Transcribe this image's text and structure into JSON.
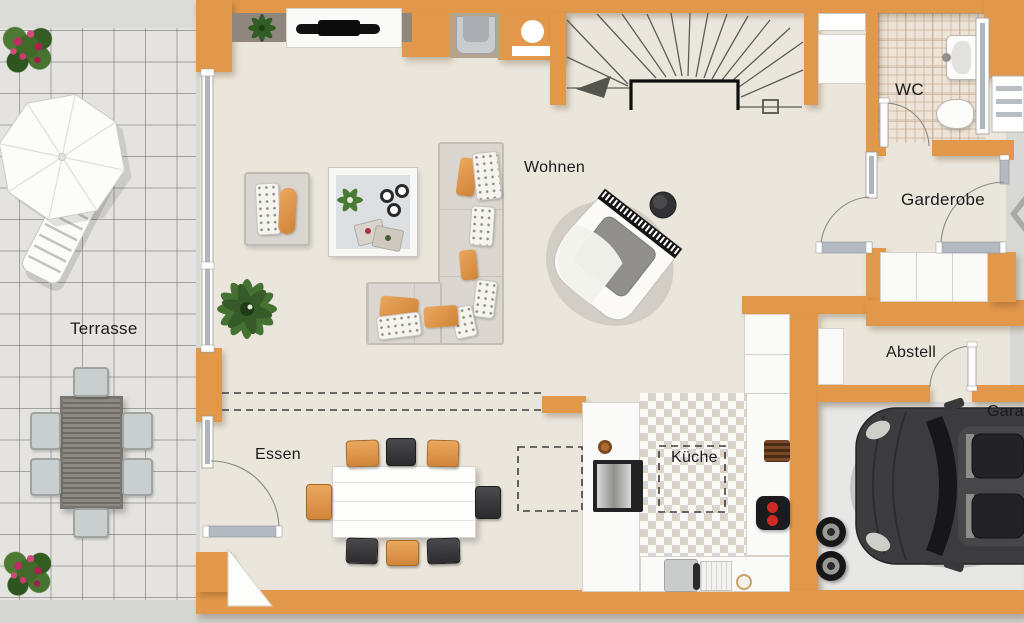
{
  "meta": {
    "title": "Grundriss Erdgeschoss"
  },
  "rooms": {
    "terrasse": {
      "label": "Terrasse"
    },
    "wohnen": {
      "label": "Wohnen"
    },
    "essen": {
      "label": "Essen"
    },
    "kueche": {
      "label": "Küche"
    },
    "wc": {
      "label": "WC"
    },
    "garderobe": {
      "label": "Garderobe"
    },
    "abstell": {
      "label": "Abstell"
    },
    "garage": {
      "label": "Garage"
    }
  },
  "colors": {
    "wall_orange": "#E2984B",
    "interior_floor": "#EBE6DC",
    "terrace_tile": "#E4E3DF",
    "garage_floor": "#E7E7E6",
    "outside_gray": "#D9D9D7",
    "accent_chair_orange": "#E0913F",
    "accent_chair_black": "#3A3A3C",
    "car_body": "#3C3C3F"
  },
  "icons": [
    "sun-umbrella-icon",
    "lounger-icon",
    "outdoor-dining-set-icon",
    "flower-bush-icon",
    "corner-sofa-icon",
    "coffee-table-icon",
    "armchair-icon",
    "plant-icon",
    "tv-sideboard-icon",
    "grand-piano-icon",
    "piano-stool-icon",
    "stair-icon",
    "stair-direction-arrow-icon",
    "dining-table-icon",
    "cooktop-icon",
    "sink-icon",
    "coffee-machine-icon",
    "washbasin-icon",
    "toilet-icon",
    "wardrobe-icon",
    "shelf-icon",
    "car-icon",
    "spare-tires-icon",
    "entrance-arrow-icon",
    "door-swing-icon",
    "window-icon"
  ]
}
